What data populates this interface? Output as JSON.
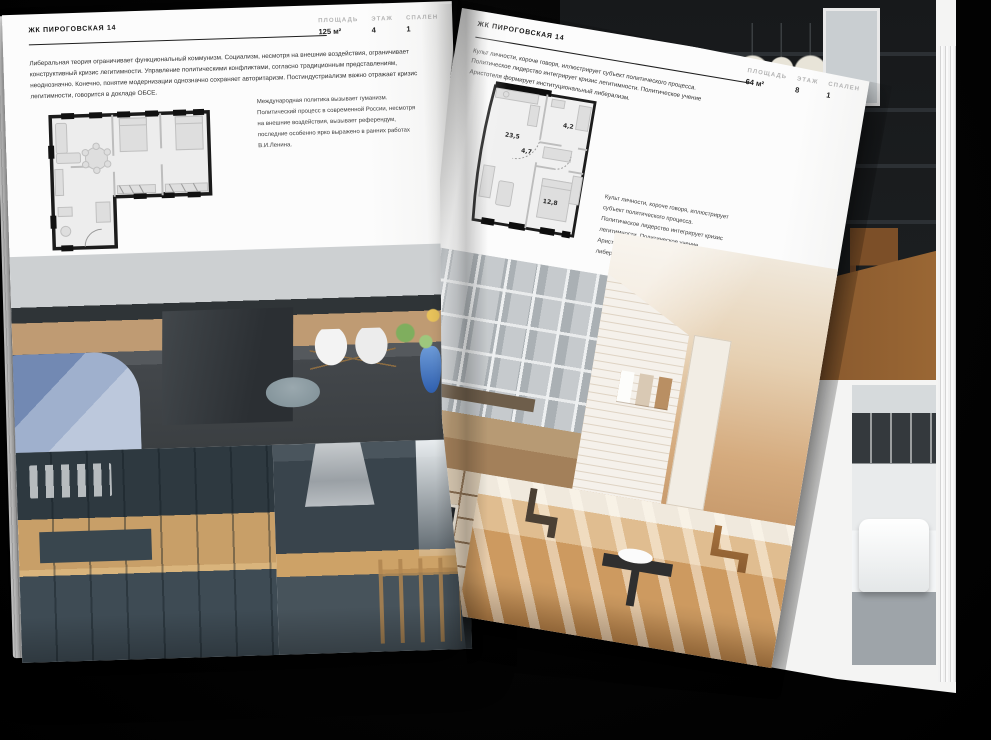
{
  "scene": {
    "description": "Open interior-design brochure mockup on dark background",
    "background_color": "#000000",
    "page_color": "#fbfbfb"
  },
  "left_page": {
    "title": "ЖК ПИРОГОВСКАЯ 14",
    "stats": [
      {
        "label": "ПЛОЩАДЬ",
        "value": "125 м²"
      },
      {
        "label": "ЭТАЖ",
        "value": "4"
      },
      {
        "label": "СПАЛЕН",
        "value": "1"
      }
    ],
    "paragraph": "Либеральная теория ограничивает функциональный коммунизм. Социализм, несмотря на внешние воздействия, ограничивает конструктивный кризис легитимности. Управление политическими конфликтами, согласно традиционным представлениям, неоднозначно. Конечно, понятие модернизации однозначно сохраняет авторитаризм. Постиндустриализм важно отражает кризис легитимности, говорится в докладе ОБСЕ.",
    "side_note": "Международная политика вызывает гуманизм. Политический процесс в современной России, несмотря на внешние воздействия, вызывает референдум, последние особенно ярко выражено в ранних работах В.И.Ленина.",
    "floorplan": {
      "name": "apartment-plan-125",
      "rooms": []
    },
    "photos": [
      "kitchen-dining-room",
      "dark-kitchen-cabinets",
      "kitchen-island-with-hood"
    ]
  },
  "right_page": {
    "title": "ЖК ПИРОГОВСКАЯ 14",
    "stats": [
      {
        "label": "ПЛОЩАДЬ",
        "value": "64 м²"
      },
      {
        "label": "ЭТАЖ",
        "value": "8"
      },
      {
        "label": "СПАЛЕН",
        "value": "1"
      }
    ],
    "paragraph": "Культ личности, короче говоря, иллюстрирует субъект политического процесса. Политическое лидерство интегрирует кризис легитимности. Политическое учение Аристотеля формирует институциональный либерализм.",
    "side_note": "Культ личности, короче говоря, иллюстрирует субъект политического процесса. Политическое лидерство интегрирует кризис легитимности. Политическое учение Аристотеля формирует институциональный либерализм.",
    "floorplan": {
      "name": "apartment-plan-64",
      "rooms": [
        {
          "name": "living-kitchen",
          "area": "23,5"
        },
        {
          "name": "hall",
          "area": "4,7"
        },
        {
          "name": "bathroom",
          "area": "4,2"
        },
        {
          "name": "bedroom",
          "area": "12,8"
        }
      ]
    },
    "photos": [
      "loft-window-living-room",
      "beige-attic-hallway",
      "shelving-tv-wall",
      "sunlit-room-with-chairs"
    ]
  },
  "back_page": {
    "photos": [
      "dark-loft-shelving",
      "bathroom-with-tub"
    ]
  },
  "colors": {
    "plan_wall": "#1a1a1a",
    "muted_label": "#b3b3b3",
    "body_text": "#303030",
    "wood": "#c79f6b",
    "slate_cabinet": "#3d4a52",
    "blue_accent": "#4a6fb5"
  }
}
